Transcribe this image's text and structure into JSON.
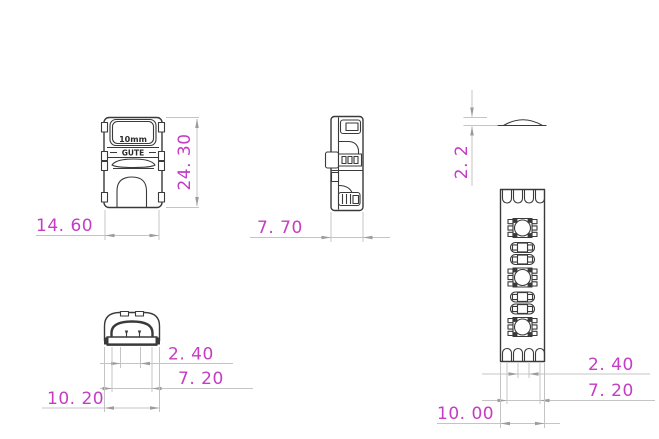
{
  "drawing": {
    "front_view": {
      "marking_line1": "10mm",
      "marking_line2": "GUTE",
      "height_label": "24. 30",
      "width_label": "14. 60"
    },
    "side_view": {
      "depth_label": "7. 70"
    },
    "lens_profile": {
      "height_label": "2. 2"
    },
    "bottom_view": {
      "pin_spacing_label": "2. 40",
      "slot_width_label": "7. 20",
      "overall_width_label": "10. 20"
    },
    "led_strip": {
      "pad_pitch_label": "2. 40",
      "pad_span_label": "7. 20",
      "strip_width_label": "10. 00"
    },
    "colors": {
      "dimension_text": "#c53cc5",
      "drawing_line": "#3a3a3a",
      "dimension_line": "#c4c4c4",
      "arrowhead": "#9c9c9c",
      "background": "#ffffff"
    }
  }
}
